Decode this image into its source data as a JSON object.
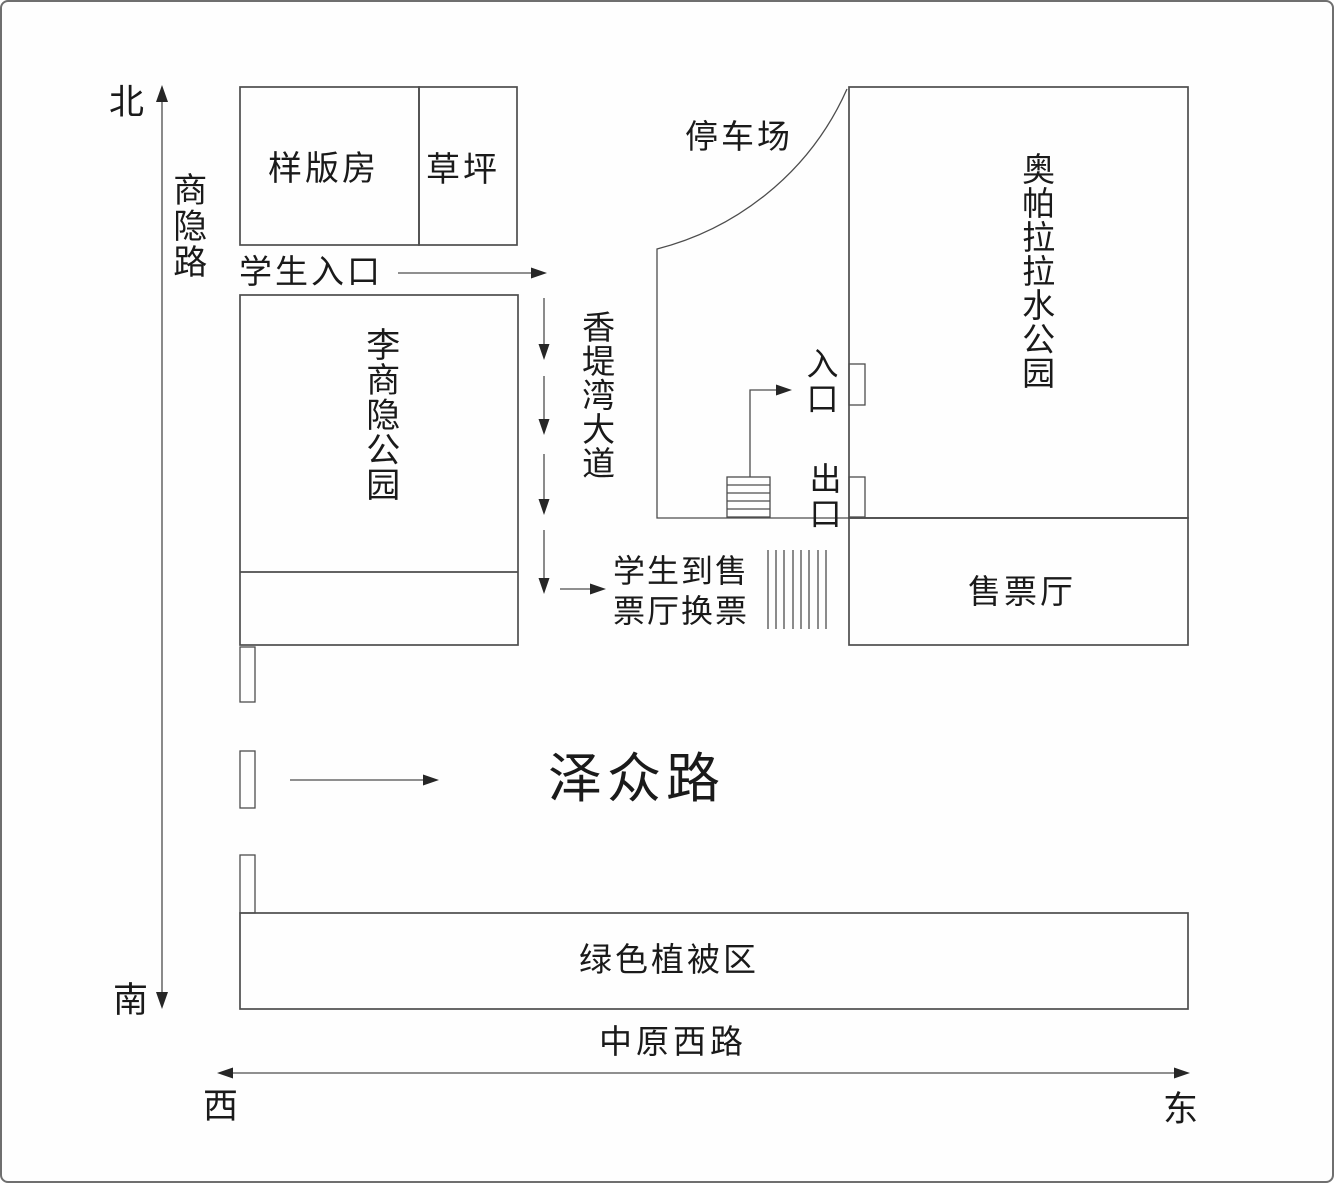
{
  "compass": {
    "north": "北",
    "south": "南",
    "west": "西",
    "east": "东"
  },
  "roads": {
    "shangyin": "商隐路",
    "xiangdiwan": "香堤湾大道",
    "zezhong": "泽众路",
    "zhongyuan_west": "中原西路"
  },
  "places": {
    "sample_room": "样版房",
    "lawn": "草坪",
    "li_shangyin_park": "李商隐公园",
    "parking_lot": "停车场",
    "water_park": "奥帕拉拉水公园",
    "ticket_hall": "售票厅",
    "green_vegetation": "绿色植被区"
  },
  "annotations": {
    "student_entrance": "学生入口",
    "entrance": "入口",
    "exit": "出口",
    "exchange_note": "学生到售票厅换票"
  },
  "colors": {
    "line": "#4d4d4d",
    "arrow": "#262626",
    "text": "#1a1a1a"
  }
}
